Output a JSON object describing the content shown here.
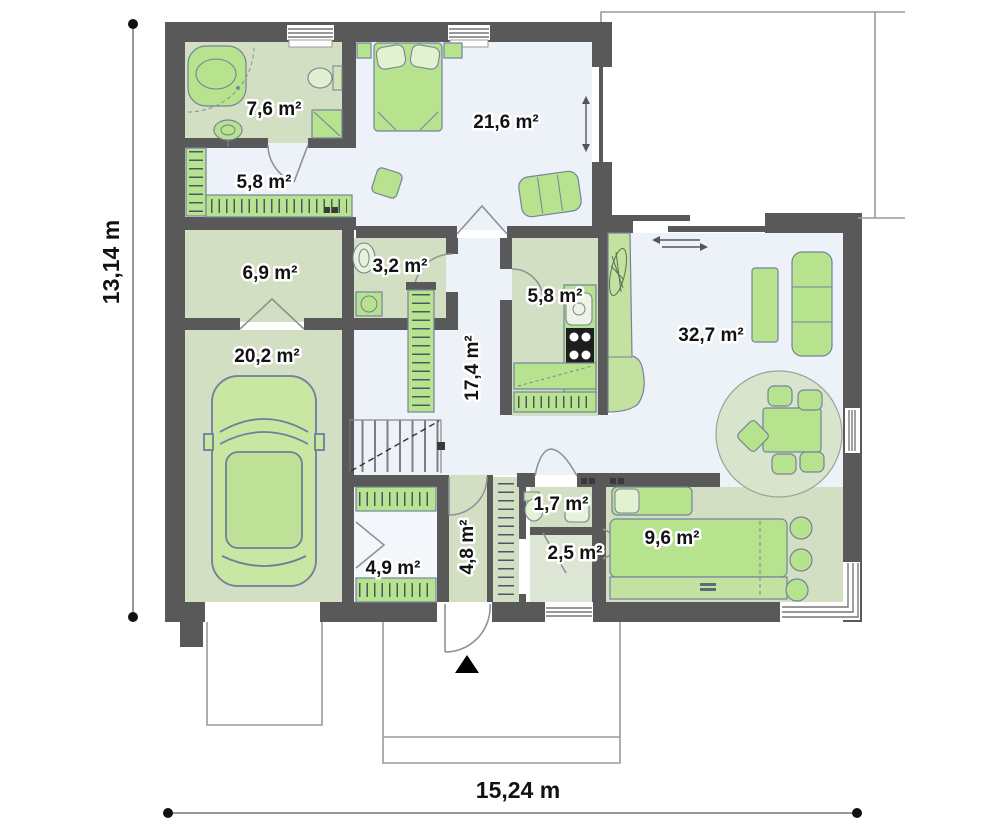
{
  "plan": {
    "rooms": {
      "bathroom": {
        "name": "bathroom",
        "area": "7,6 m²"
      },
      "wardrobe": {
        "name": "walk-in wardrobe",
        "area": "5,8 m²"
      },
      "bedroom": {
        "name": "bedroom",
        "area": "21,6 m²"
      },
      "utility": {
        "name": "utility room",
        "area": "6,9 m²"
      },
      "wc": {
        "name": "wc",
        "area": "3,2 m²"
      },
      "kitchen": {
        "name": "kitchen",
        "area": "5,8 m²"
      },
      "hall": {
        "name": "hall",
        "area": "17,4 m²"
      },
      "living_room": {
        "name": "living room",
        "area": "32,7 m²"
      },
      "garage": {
        "name": "garage",
        "area": "20,2 m²"
      },
      "closet": {
        "name": "closet",
        "area": "4,9 m²"
      },
      "entry": {
        "name": "entry",
        "area": "4,8 m²"
      },
      "toilet": {
        "name": "toilet",
        "area": "1,7 m²"
      },
      "corridor": {
        "name": "corridor",
        "area": "2,5 m²"
      },
      "study": {
        "name": "study",
        "area": "9,6 m²"
      }
    },
    "dimensions": {
      "width": "15,24 m",
      "height": "13,14 m"
    },
    "colors": {
      "wall": "#595959",
      "floor_green": "#d3dfc3",
      "floor_blue": "#edf1f8",
      "furniture_green": "#b7e38f",
      "rug_green": "#d9e4cc",
      "outline_gray": "#9a9a9a"
    }
  }
}
